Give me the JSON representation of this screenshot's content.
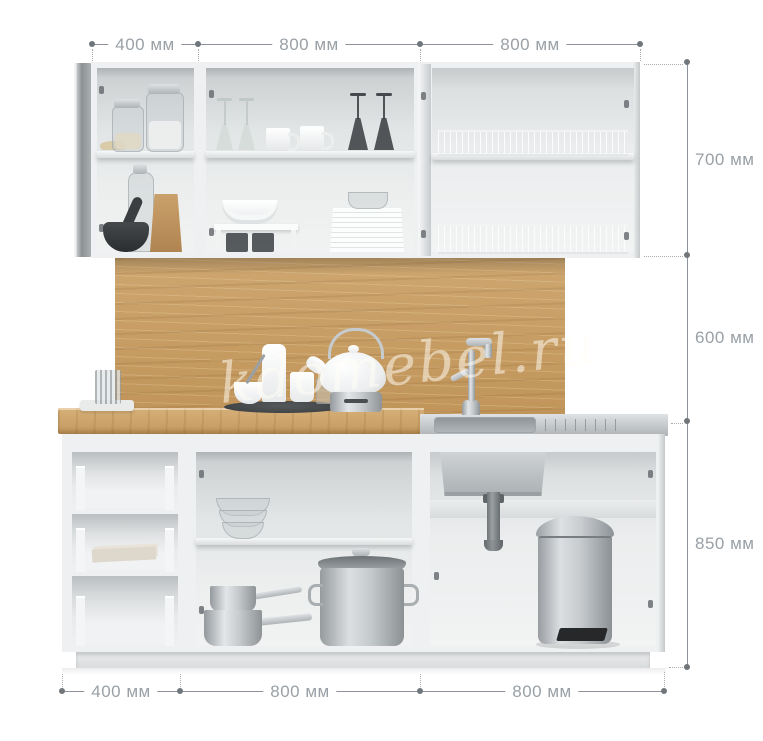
{
  "dimensions": {
    "unit": "мм",
    "top": [
      {
        "label": "400 мм"
      },
      {
        "label": "800 мм"
      },
      {
        "label": "800 мм"
      }
    ],
    "right": [
      {
        "label": "700 мм"
      },
      {
        "label": "600 мм"
      },
      {
        "label": "850 мм"
      }
    ],
    "bottom": [
      {
        "label": "400 мм"
      },
      {
        "label": "800 мм"
      },
      {
        "label": "800 мм"
      }
    ]
  },
  "watermark": {
    "text": "kdomebel.ru"
  },
  "colors": {
    "background": "#ffffff",
    "dimension_text": "#99a0a6",
    "dimension_line": "#8d9398",
    "cabinet_white": "#eef0f1",
    "wood_oak": "#c79e66",
    "stainless_steel": "#c3c8cb",
    "dark_utensil": "#34383a"
  },
  "scene": {
    "upper_cabinets": [
      "glass-jars",
      "glass-bottle",
      "mortar-and-pestle",
      "paper-bag",
      "wine-glasses",
      "mugs",
      "bowls-on-riser",
      "plate-stack",
      "dish-drying-racks"
    ],
    "counter": [
      "napkin-and-glass",
      "serving-tray",
      "storage-jars",
      "teapot-on-burner",
      "stainless-sink",
      "faucet",
      "drainboard-grooves"
    ],
    "base_cabinets": [
      "three-open-drawers",
      "papers-in-drawer",
      "glass-bowl-stack",
      "saucepan-stack",
      "stock-pot",
      "sink-bowl-underside",
      "siphon-pipe",
      "pedal-trash-bin",
      "plinth"
    ]
  }
}
